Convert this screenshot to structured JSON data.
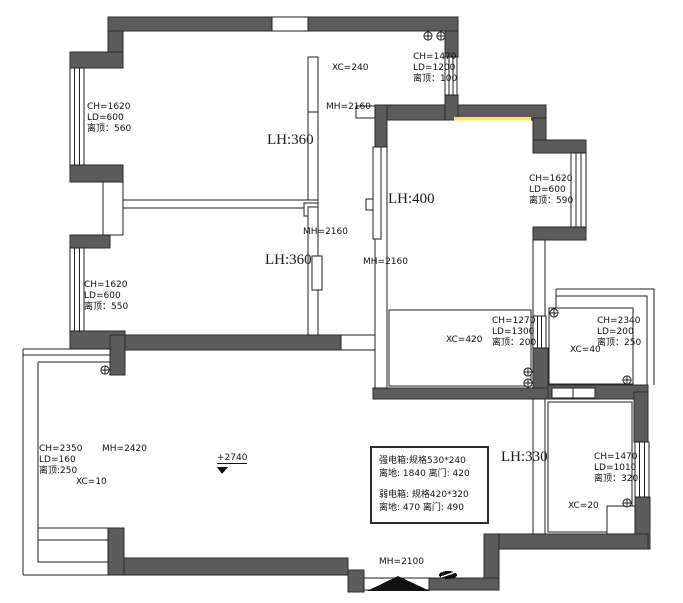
{
  "colors": {
    "wall": "#5c5c5c",
    "line": "#1f1f1f",
    "highlight": "#ffe94a"
  },
  "annotations": {
    "win_tl": {
      "l1": "CH=1620",
      "l2": "LD=600",
      "l3": "离顶：560"
    },
    "lh360_top": "LH:360",
    "xc240": "XC=240",
    "win_tr": {
      "l1": "CH=1470",
      "l2": "LD=1200",
      "l3": "离顶：100"
    },
    "mh2160_top": "MH=2160",
    "lh400": "LH:400",
    "win_right": {
      "l1": "CH=1620",
      "l2": "LD=600",
      "l3": "离顶：590"
    },
    "mh2160_mid": "MH=2160",
    "lh360_bottom": "LH:360",
    "mh2160_hall": "MH=2160",
    "win_ml": {
      "l1": "CH=1620",
      "l2": "LD=600",
      "l3": "离顶：550"
    },
    "win_kitchen": {
      "l1": "CH=1270",
      "l2": "LD=1300",
      "l3": "离顶：200"
    },
    "xc420": "XC=420",
    "win_xc40": {
      "l1": "CH=2340",
      "l2": "LD=200",
      "l3": "离顶：250"
    },
    "xc40": "XC=40",
    "win_ll": {
      "l1": "CH=2350",
      "l2": "LD=160",
      "l3": "离顶:250"
    },
    "mh2420": "MH=2420",
    "xc10": "XC=10",
    "elevation": "+2740",
    "lh330": "LH:330",
    "win_br": {
      "l1": "CH=1470",
      "l2": "LD=1010",
      "l3": "离顶：320"
    },
    "xc20": "XC=20",
    "mh2100": "MH=2100",
    "elec_box": {
      "l1": "强电箱:规格530*240",
      "l2": "离地: 1840 离门: 420",
      "l3": "弱电箱: 规格420*320",
      "l4": "离地: 470 离门: 490"
    }
  }
}
